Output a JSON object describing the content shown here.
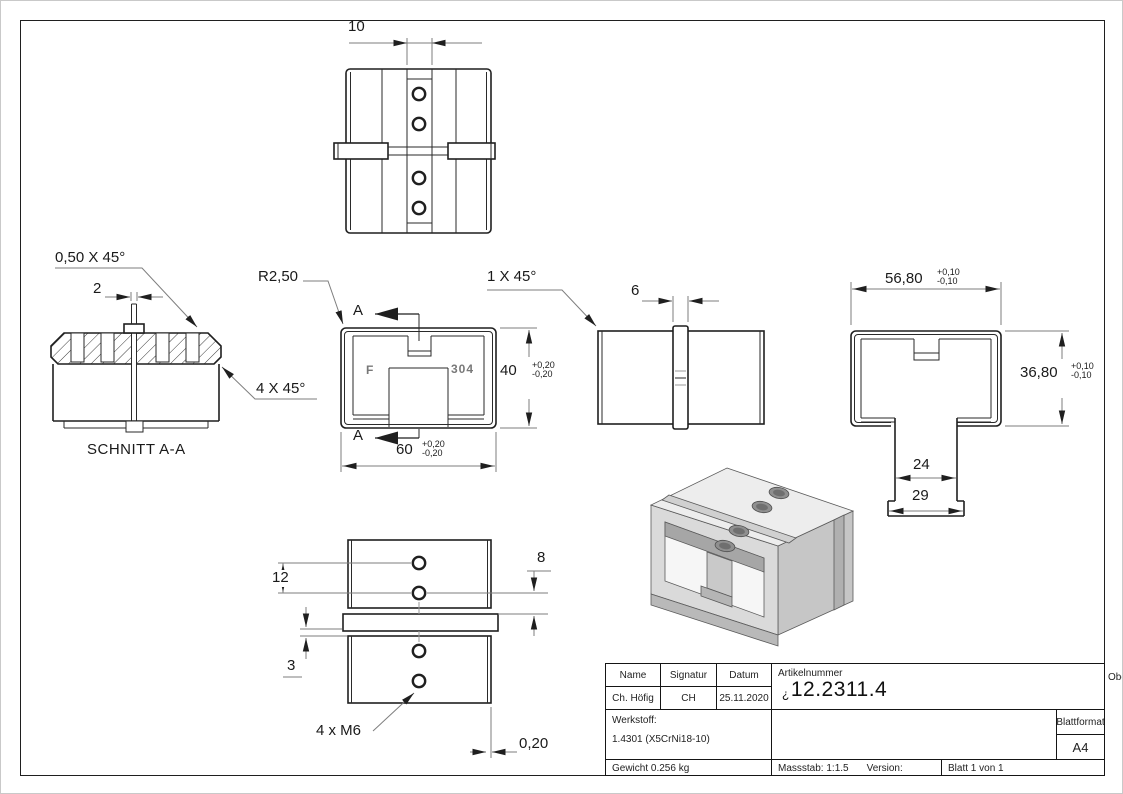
{
  "drawing": {
    "views": {
      "top": {
        "dim_width": "10"
      },
      "section": {
        "title": "SCHNITT A-A",
        "chamfer_small": "0,50 X 45°",
        "slit_width": "2",
        "chamfer_large": "4 X 45°"
      },
      "front": {
        "radius": "R2,50",
        "section_letter": "A",
        "stamp_left": "F",
        "stamp_right": "304",
        "width": "60",
        "width_tol": {
          "plus": "+0,20",
          "minus": "-0,20"
        },
        "height": "40",
        "height_tol": {
          "plus": "+0,20",
          "minus": "-0,20"
        }
      },
      "side": {
        "chamfer": "1 X 45°",
        "collar_width": "6"
      },
      "end": {
        "width": "56,80",
        "width_tol": {
          "plus": "+0,10",
          "minus": "-0,10"
        },
        "height": "36,80",
        "height_tol": {
          "plus": "+0,10",
          "minus": "-0,10"
        },
        "slot_width": "24",
        "leg_width": "29"
      },
      "bottom": {
        "hole_spacing": "12",
        "hole_edge": "8",
        "collar_edge": "3",
        "thread_label": "4 x M6",
        "edge_offset": "0,20"
      }
    },
    "title_block": {
      "name_header": "Name",
      "signature_header": "Signatur",
      "date_header": "Datum",
      "name": "Ch. Höfig",
      "signature": "CH",
      "date": "25.11.2020",
      "article_header": "Artikelnummer",
      "article_prefix": "¿",
      "article_number": "12.2311.4",
      "surface_label": "Oberfläche:",
      "surface_value": "Geschliffen Korn 240",
      "material_label": "Werkstoff:",
      "material_value": "1.4301 (X5CrNi18-10)",
      "format_label": "Blattformat",
      "format_value": "A4",
      "weight": "Gewicht 0.256 kg",
      "scale": "Massstab: 1:1.5",
      "version_label": "Version:",
      "sheet": "Blatt 1 von 1"
    }
  }
}
